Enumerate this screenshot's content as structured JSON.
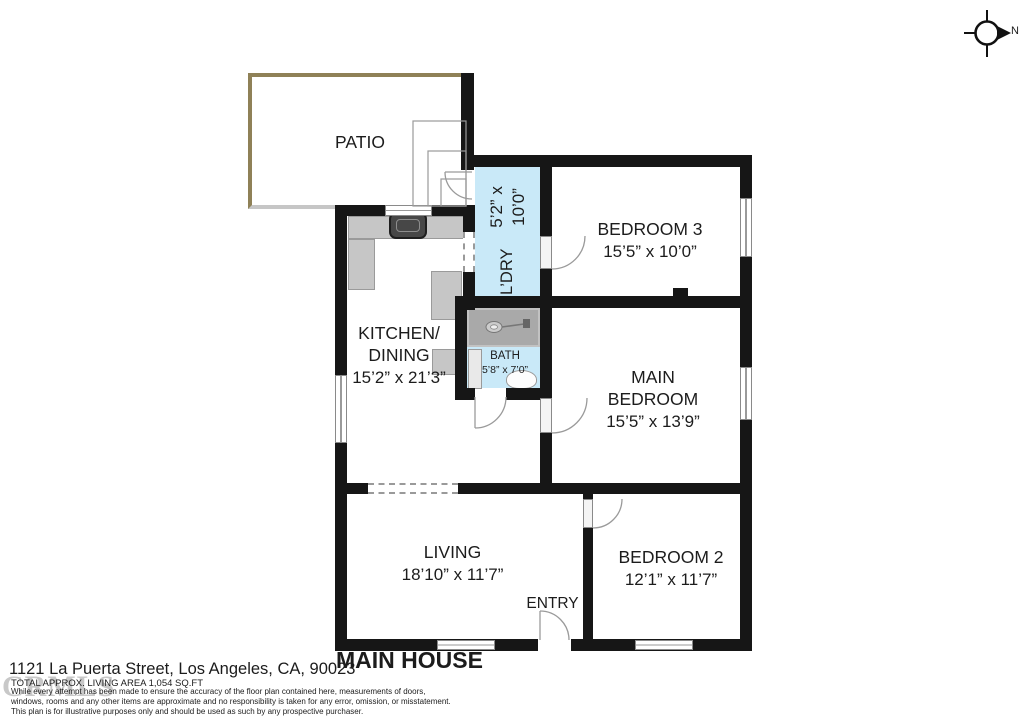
{
  "compass": {
    "north": "N"
  },
  "rooms": {
    "patio": {
      "label": "PATIO"
    },
    "laundry": {
      "label": "L’DRY",
      "dims": "5’2” x 10’0”"
    },
    "bedroom3": {
      "label": "BEDROOM 3",
      "dims": "15’5” x 10’0”"
    },
    "kitchen": {
      "label_line1": "KITCHEN/",
      "label_line2": "DINING",
      "dims": "15’2” x 21’3”"
    },
    "bath": {
      "label": "BATH",
      "dims": "5’8” x 7’0”"
    },
    "main_bedroom": {
      "label_line1": "MAIN",
      "label_line2": "BEDROOM",
      "dims": "15’5” x 13’9”"
    },
    "living": {
      "label": "LIVING",
      "dims": "18’10” x 11’7”"
    },
    "entry": {
      "label": "ENTRY"
    },
    "bedroom2": {
      "label": "BEDROOM 2",
      "dims": "12’1” x 11’7”"
    }
  },
  "footer": {
    "plan_title": "MAIN HOUSE",
    "address": "1121 La Puerta Street, Los Angeles, CA, 90023",
    "area": "TOTAL APPROX. LIVING AREA 1,054 SQ.FT",
    "disclaimer": [
      "While every attempt has been made to ensure the accuracy of the floor plan contained here, measurements of doors,",
      "windows, rooms and any other items are approximate and no responsibility is taken for any error, omission, or misstatement.",
      "This plan is for illustrative purposes only and should be used as such by any prospective purchaser."
    ],
    "watermark": "CRMLS"
  },
  "colors": {
    "wall": "#161616",
    "room_highlight": "#c9e9f8",
    "patio_border": "#8f8157",
    "counter": "#c6c6c6"
  }
}
